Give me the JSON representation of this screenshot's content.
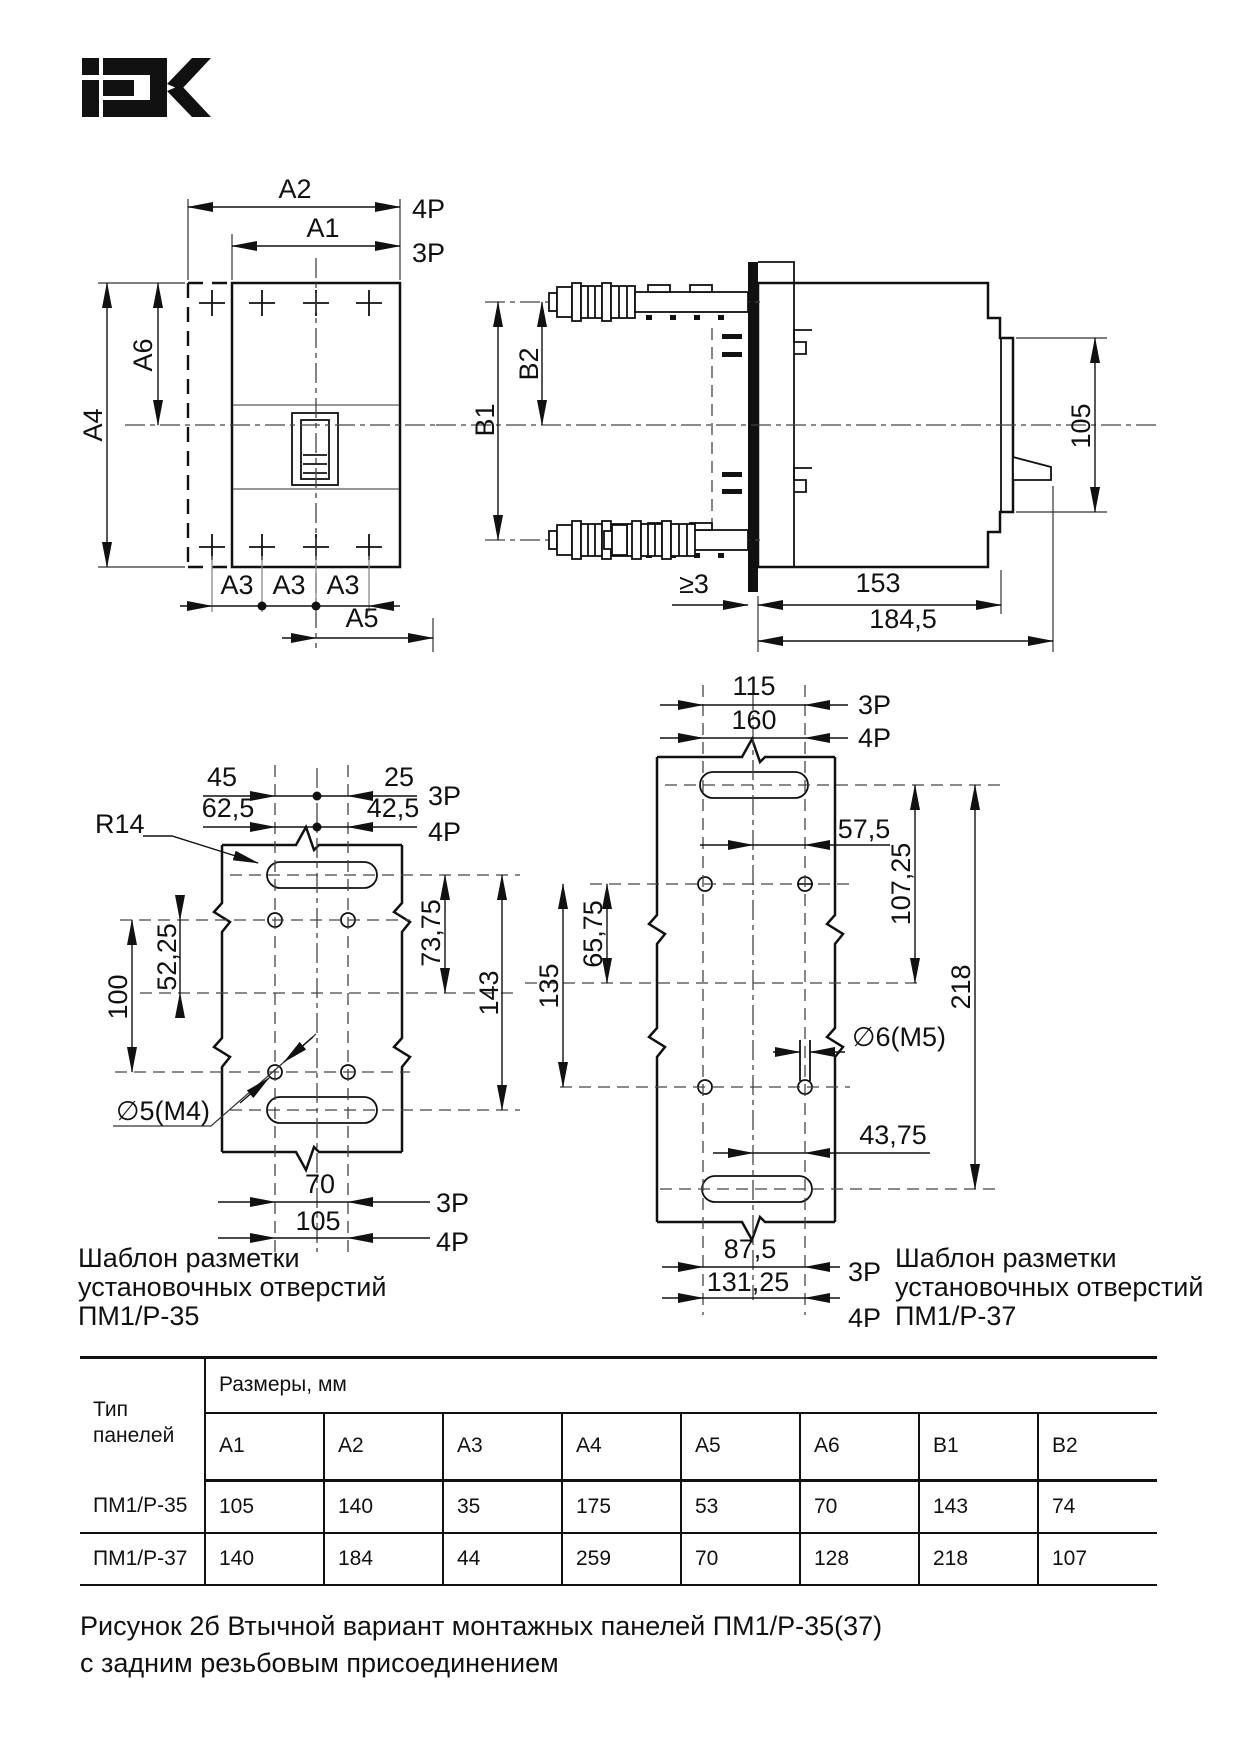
{
  "logo": {
    "brand": "IEK"
  },
  "front": {
    "a1": "A1",
    "a2": "A2",
    "a3": "A3",
    "a4": "A4",
    "a5": "A5",
    "a6": "A6",
    "p3": "3P",
    "p4": "4P"
  },
  "side": {
    "b1": "B1",
    "b2": "B2",
    "d105": "105",
    "gap": "≥3",
    "d153": "153",
    "d1845": "184,5"
  },
  "t35": {
    "d45": "45",
    "d25": "25",
    "d625": "62,5",
    "d425": "42,5",
    "p3": "3P",
    "p4": "4P",
    "r14": "R14",
    "d5225": "52,25",
    "d100": "100",
    "d7375": "73,75",
    "d143": "143",
    "hole": "∅5(M4)",
    "d70": "70",
    "d105": "105",
    "cap1": "Шаблон разметки",
    "cap2": "установочных отверстий",
    "cap3": "ПМ1/Р-35"
  },
  "t37": {
    "d115": "115",
    "d160": "160",
    "p3": "3P",
    "p4": "4P",
    "d575": "57,5",
    "d10725": "107,25",
    "d218": "218",
    "d6575": "65,75",
    "d135": "135",
    "hole": "∅6(M5)",
    "d4375": "43,75",
    "d875": "87,5",
    "d13125": "131,25",
    "cap1": "Шаблон разметки",
    "cap2": "установочных отверстий",
    "cap3": "ПМ1/Р-37"
  },
  "table": {
    "type1": "Тип",
    "type2": "панелей",
    "sizes": "Размеры, мм",
    "columns": [
      "A1",
      "A2",
      "A3",
      "A4",
      "A5",
      "A6",
      "B1",
      "B2"
    ],
    "rows": [
      {
        "name": "ПМ1/Р-35",
        "values": [
          "105",
          "140",
          "35",
          "175",
          "53",
          "70",
          "143",
          "74"
        ]
      },
      {
        "name": "ПМ1/Р-37",
        "values": [
          "140",
          "184",
          "44",
          "259",
          "70",
          "128",
          "218",
          "107"
        ]
      }
    ]
  },
  "caption": {
    "line1": "Рисунок 2б  Втычной вариант монтажных панелей ПМ1/Р-35(37)",
    "line2": "с задним резьбовым присоединением"
  }
}
